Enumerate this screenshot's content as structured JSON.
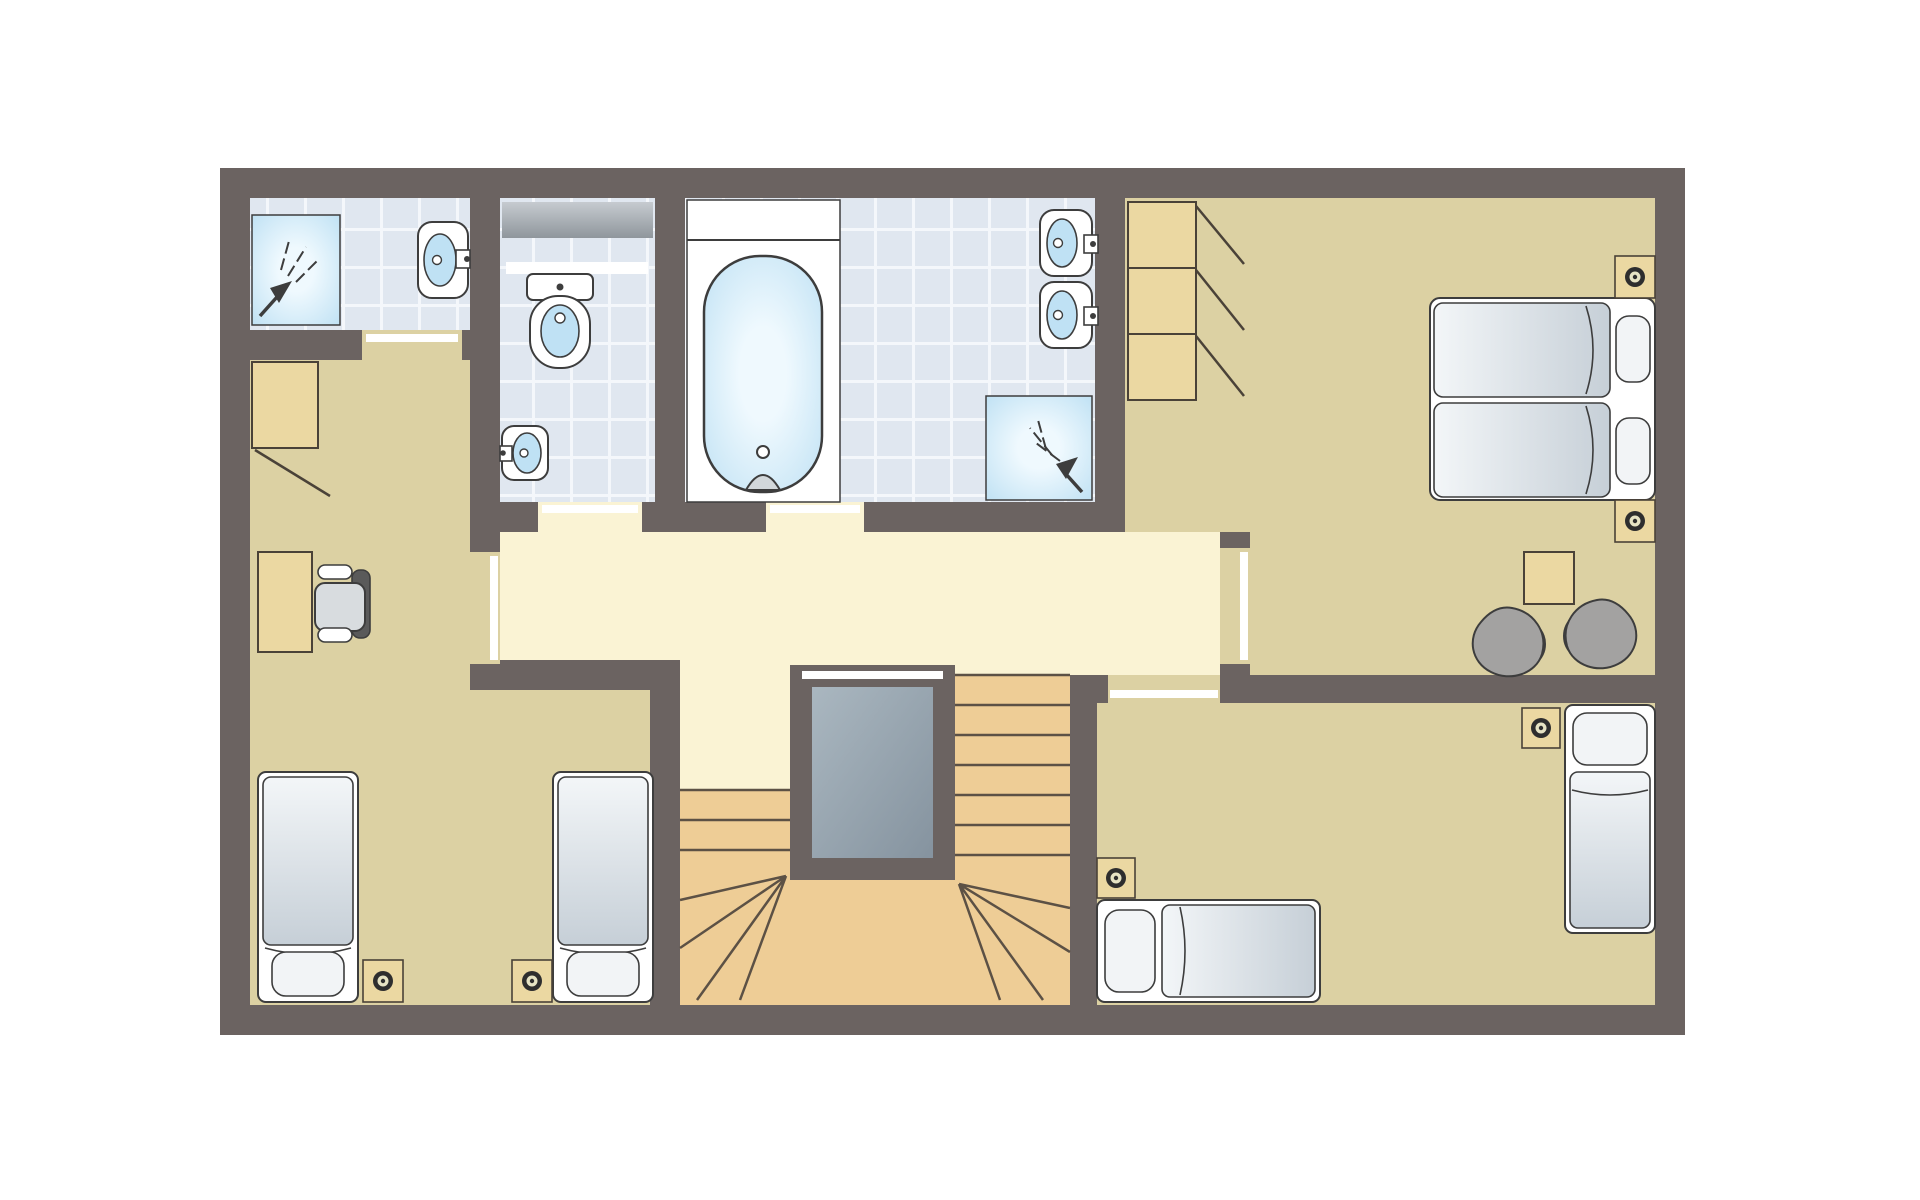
{
  "meta": {
    "description": "Architectural floor plan of an upper storey: shower room, WC, family bathroom, three bedrooms, landing and U-shaped staircase around a stairwell void",
    "visible_text": []
  },
  "palette": {
    "page-bg": "#ffffff",
    "wall": "#6b6361",
    "floor-bedroom": "#dcd1a3",
    "floor-hall": "#faf3d4",
    "tile": "#e0e7f0",
    "tile-grout": "#f4f7fb",
    "water-light": "#eff9fe",
    "water-mid": "#b7ddf2",
    "water-bowl": "#bfe1f4",
    "white": "#ffffff",
    "outline": "#3d3d3d",
    "wood": "#ebd8a2",
    "wood-stroke": "#4a4238",
    "stair": "#eecd96",
    "stair-line": "#5c5145",
    "void-from": "#aab7c0",
    "void-to": "#85939f",
    "counter-from": "#c6cbd0",
    "counter-to": "#8f969c",
    "mattress-light": "#f3f6f8",
    "mattress-dark": "#c6cfd7",
    "pillow": "#f2f4f6",
    "chair-grey": "#a3a2a1",
    "seat-grey": "#d8dcdf",
    "backrest-grey": "#5a5a5a",
    "lamp-dark": "#2e2e2e",
    "lamp-light": "#e6e3c4",
    "faucet-grey": "#d2d7da"
  },
  "rooms": [
    {
      "id": "shower-room",
      "floor": "tile",
      "fixtures": [
        "shower",
        "washbasin"
      ],
      "doors": 1
    },
    {
      "id": "wc",
      "floor": "tile",
      "fixtures": [
        "counter",
        "shelf",
        "toilet",
        "corner-washbasin"
      ],
      "doors": 1
    },
    {
      "id": "bathroom",
      "floor": "tile",
      "fixtures": [
        "bathtub",
        "washbasin",
        "washbasin",
        "shower"
      ],
      "doors": 1
    },
    {
      "id": "bedroom-top-right",
      "floor": "bedroom",
      "fixtures": [
        "wardrobe-3-door",
        "double-bed",
        "nightstand-lamp",
        "nightstand-lamp",
        "side-table",
        "armchair",
        "armchair"
      ],
      "doors": 1
    },
    {
      "id": "bedroom-bottom-right",
      "floor": "bedroom",
      "fixtures": [
        "single-bed",
        "single-bed",
        "nightstand-lamp",
        "nightstand-lamp"
      ],
      "doors": 1
    },
    {
      "id": "bedroom-left",
      "floor": "bedroom",
      "fixtures": [
        "wardrobe",
        "desk",
        "office-chair",
        "single-bed",
        "single-bed",
        "nightstand-lamp",
        "nightstand-lamp"
      ],
      "doors": 1
    },
    {
      "id": "landing",
      "floor": "hall",
      "fixtures": [
        "staircase-u-shaped",
        "stairwell-void",
        "railing"
      ],
      "doors": 6
    }
  ],
  "counts": {
    "bedrooms": 3,
    "bathrooms": 3,
    "beds_single": 4,
    "beds_double": 1,
    "showers": 2,
    "bathtubs": 1,
    "washbasins": 5,
    "toilets": 1
  }
}
